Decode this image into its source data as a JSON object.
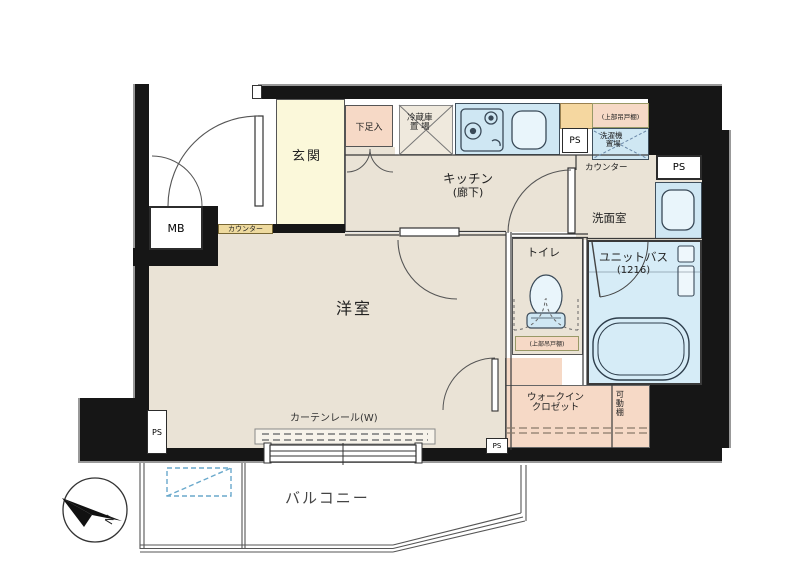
{
  "plan": {
    "type": "japanese-apartment-floor-plan",
    "labels": {
      "genkan": "玄関",
      "shoe_box": "下足入",
      "fridge_l1": "冷蔵庫",
      "fridge_l2": "置 場",
      "kitchen": "キッチン",
      "kitchen_sub": "(廊下)",
      "ps": "PS",
      "mb": "MB",
      "upper_cabinet": "(上部吊戸棚)",
      "washer_l1": "洗濯機",
      "washer_l2": "置場",
      "counter": "カウンター",
      "washroom": "洗面室",
      "toilet": "トイレ",
      "bath": "ユニットバス",
      "bath_size": "(1216)",
      "living": "洋室",
      "wic_l1": "ウォークイン",
      "wic_l2": "クロゼット",
      "movable_shelf": "可動棚",
      "curtain_rail": "カーテンレール(W)",
      "balcony": "バルコニー",
      "north": "N"
    },
    "colors": {
      "wall": "#161616",
      "floor": "#eae3d6",
      "genkan": "#fbf8da",
      "pink": "#f6d9c6",
      "blue": "#cfe7f3",
      "bath_blue": "#d6ecf7",
      "counter_tan": "#eeda9f",
      "orange": "#f5d7a0",
      "hatch_blue": "#6aa9cc"
    }
  }
}
